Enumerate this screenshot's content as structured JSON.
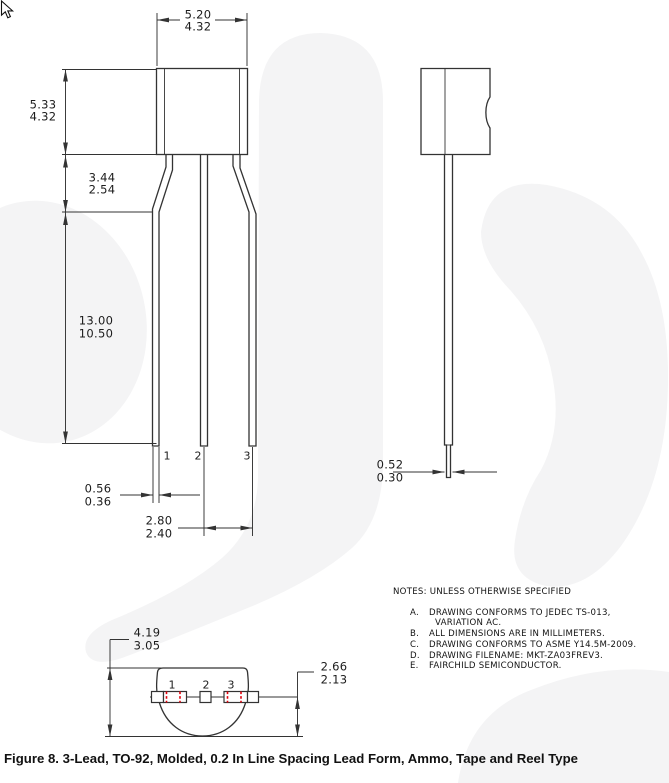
{
  "figure": {
    "caption": "Figure 8. 3-Lead, TO-92, Molded, 0.2 In Line Spacing Lead Form, Ammo, Tape and Reel Type"
  },
  "front_view": {
    "dim_top_width": {
      "max": "5.20",
      "min": "4.32"
    },
    "dim_body_height": {
      "max": "5.33",
      "min": "4.32"
    },
    "dim_shoulder": {
      "max": "3.44",
      "min": "2.54"
    },
    "dim_lead_length": {
      "max": "13.00",
      "min": "10.50"
    },
    "dim_lead_width": {
      "max": "0.56",
      "min": "0.36"
    },
    "dim_lead_spacing": {
      "max": "2.80",
      "min": "2.40"
    },
    "lead_labels": [
      "1",
      "2",
      "3"
    ]
  },
  "side_view": {
    "dim_lead_thickness": {
      "max": "0.52",
      "min": "0.30"
    }
  },
  "bottom_view": {
    "dim_body_depth": {
      "max": "4.19",
      "min": "3.05"
    },
    "dim_standoff": {
      "max": "2.66",
      "min": "2.13"
    },
    "lead_labels": [
      "1",
      "2",
      "3"
    ]
  },
  "notes": {
    "header": "NOTES: UNLESS OTHERWISE SPECIFIED",
    "items": [
      {
        "letter": "A.",
        "text": "DRAWING CONFORMS TO JEDEC TS-013,"
      },
      {
        "letter": "",
        "text": "VARIATION AC."
      },
      {
        "letter": "B.",
        "text": "ALL DIMENSIONS ARE IN MILLIMETERS."
      },
      {
        "letter": "C.",
        "text": "DRAWING CONFORMS TO ASME Y14.5M-2009."
      },
      {
        "letter": "D.",
        "text": "DRAWING FILENAME: MKT-ZA03FREV3."
      },
      {
        "letter": "E.",
        "text": "FAIRCHILD SEMICONDUCTOR."
      }
    ]
  },
  "colors": {
    "line": "#333333",
    "red_mark": "#e1000b",
    "watermark": "#f4f4f5"
  }
}
